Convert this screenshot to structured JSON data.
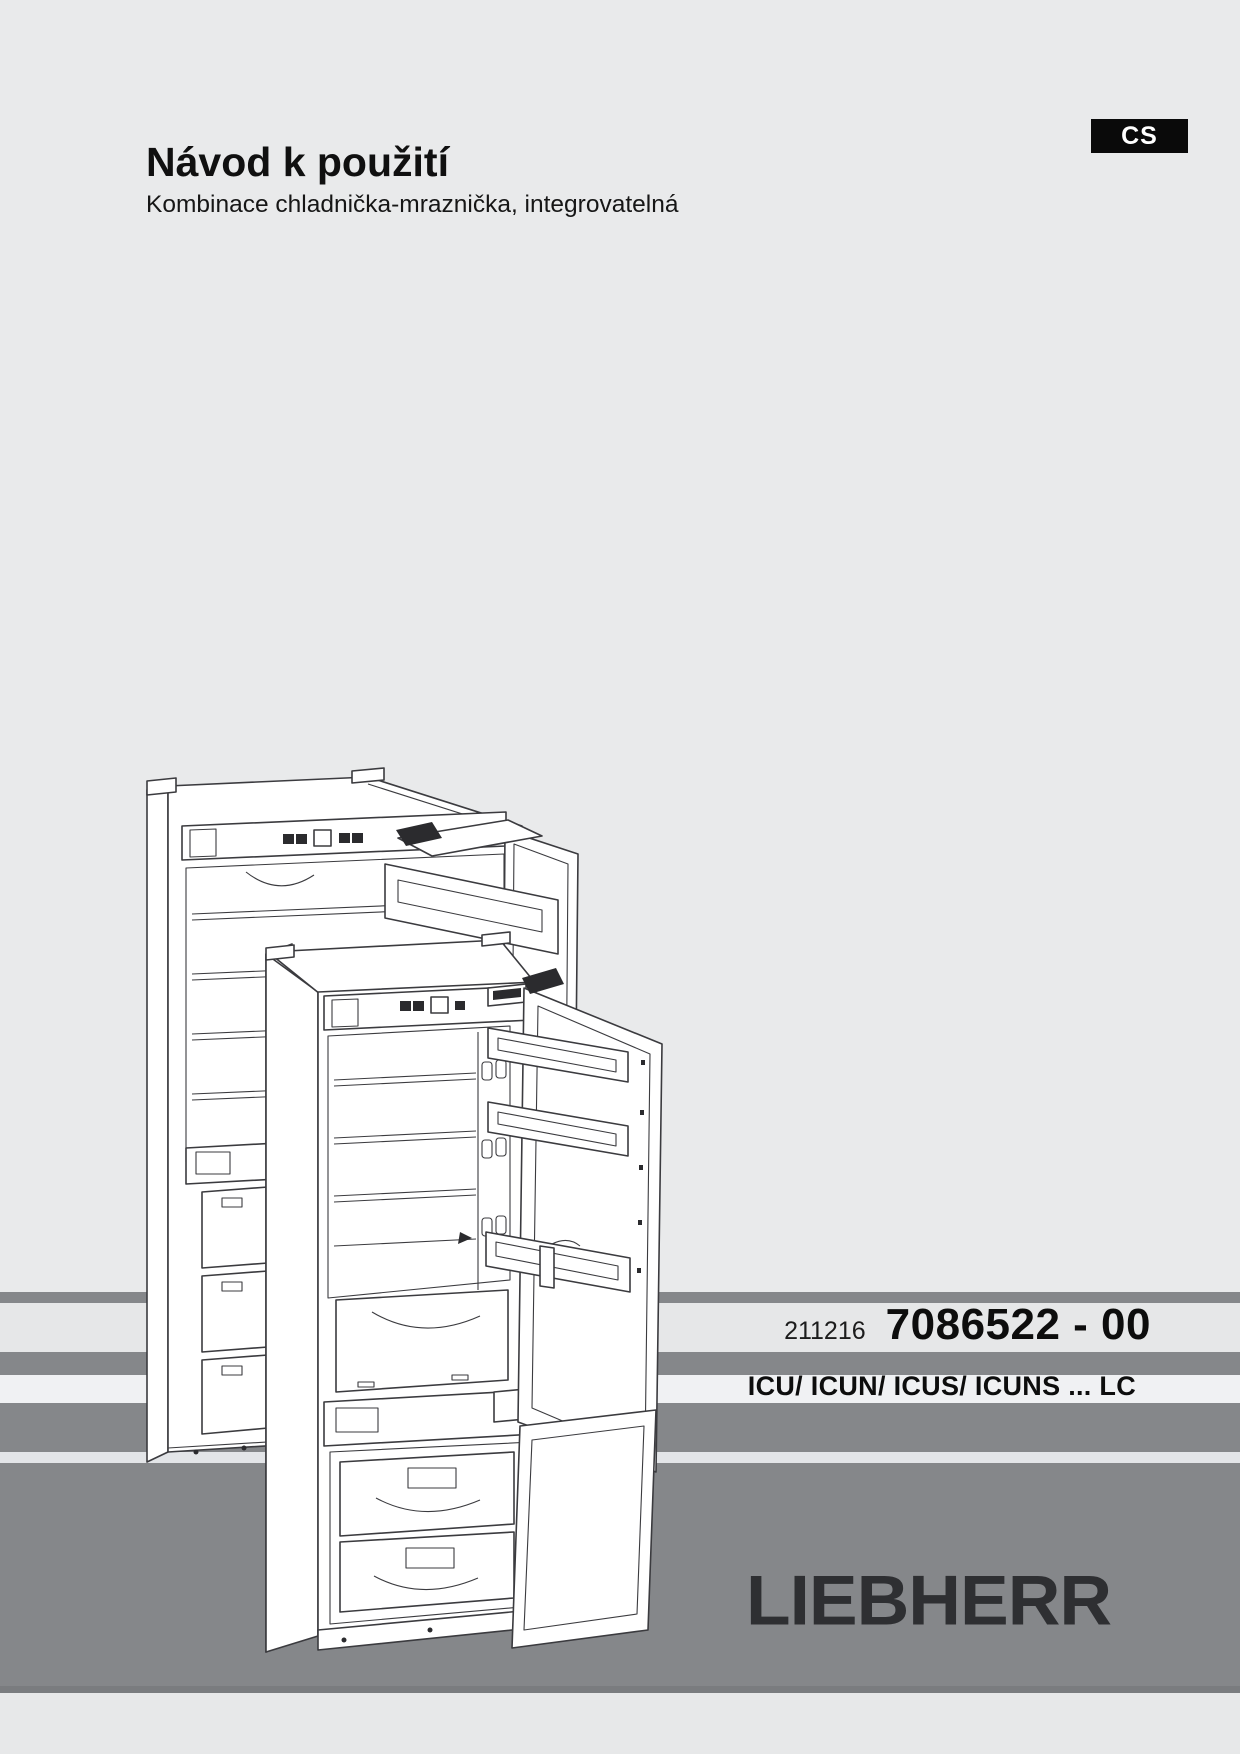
{
  "header": {
    "title": "Návod k použití",
    "subtitle": "Kombinace chladnička-mraznička, integrovatelná",
    "language_badge": "CS"
  },
  "footer": {
    "doc_number_small": "211216",
    "doc_number_large": "7086522 - 00",
    "models_line": "ICU/ ICUN/ ICUS/ ICUNS ... LC",
    "brand_logo": "LIEBHERR"
  },
  "illustration": {
    "name": "fridge-freezer-line-drawing",
    "subject": "Two integrated fridge-freezer combinations with open doors, technical line drawing"
  },
  "colors": {
    "page_background": "#e9eaeb",
    "stripe_gray": "#85878a",
    "band_light": "#e6e7e8",
    "band_white": "#f0f1f3",
    "thin_stripe": "#e3e5e8",
    "footer_block_gray": "#85878a",
    "footer_block_edge": "#7a7c7f",
    "bottom_margin": "#e7e8e9",
    "badge_background": "#0a0a0a",
    "badge_text": "#ffffff",
    "logo_color": "#2e2f32",
    "line_art_stroke": "#3b3b3f"
  }
}
